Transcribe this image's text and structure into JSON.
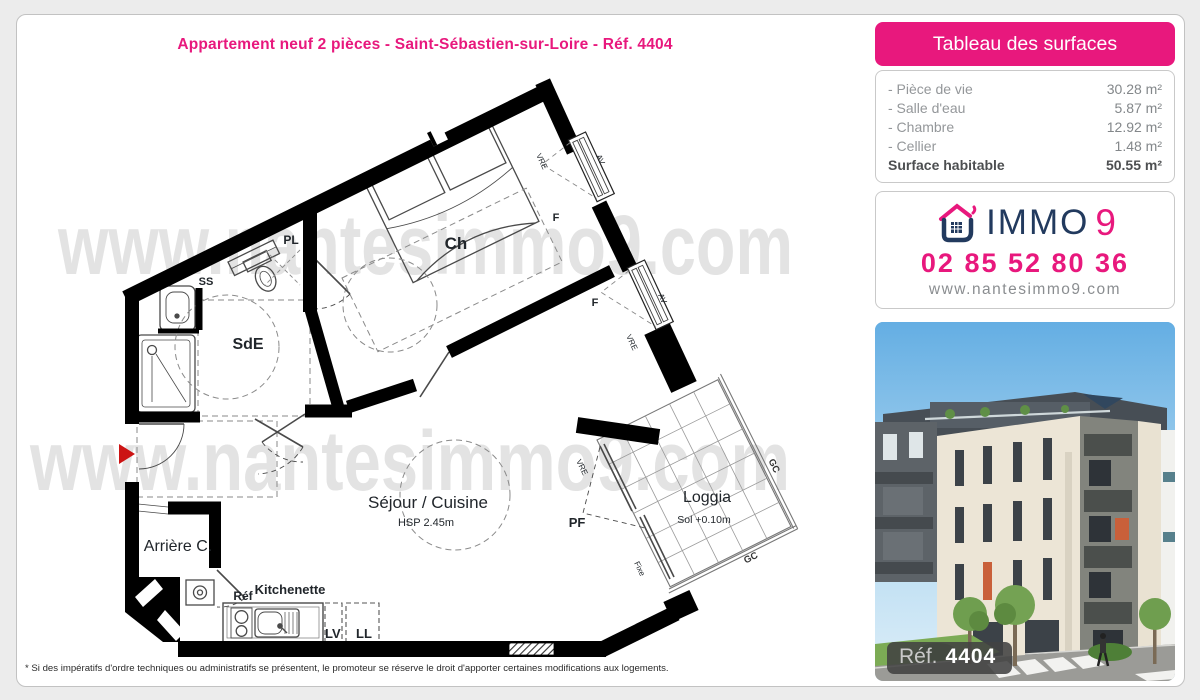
{
  "page": {
    "title": "Appartement neuf 2 pièces - Saint-Sébastien-sur-Loire - Réf. 4404",
    "disclaimer": "* Si des impératifs d'ordre techniques ou administratifs se présentent, le promoteur se réserve le droit d'apporter certaines modifications aux logements."
  },
  "surface_table": {
    "header": "Tableau des surfaces",
    "rows": [
      {
        "label": "- Pièce de vie",
        "value": "30.28 m²"
      },
      {
        "label": "- Salle d'eau",
        "value": "5.87 m²"
      },
      {
        "label": "- Chambre",
        "value": "12.92 m²"
      },
      {
        "label": "- Cellier",
        "value": "1.48 m²"
      }
    ],
    "total": {
      "label": "Surface habitable",
      "value": "50.55 m²"
    }
  },
  "agency": {
    "brand_immo": "IMMO",
    "brand_9": "9",
    "phone": "02 85 52 80 36",
    "website": "www.nantesimmo9.com"
  },
  "photo": {
    "ref_label": "Réf.",
    "ref_number": "4404"
  },
  "floorplan": {
    "watermark": "www.nantesimmo9.com",
    "labels": {
      "ch": "Ch",
      "sde": "SdE",
      "pl": "PL",
      "ss": "SS",
      "sejour": "Séjour / Cuisine",
      "hsp": "HSP 2.45m",
      "arriere": "Arrière C.",
      "kitchenette": "Kitchenette",
      "refrigerator": "Réf",
      "lv": "LV",
      "ll": "LL",
      "loggia": "Loggia",
      "sol": "Sol +0.10m",
      "pf": "PF",
      "f": "F",
      "av": "AV",
      "vre": "VRE",
      "gc": "GC",
      "fixe": "Fixe"
    }
  },
  "colors": {
    "accent_pink": "#e8187d",
    "brand_navy": "#223a5e",
    "wall_black": "#000000",
    "entrance_arrow_red": "#cc1414"
  }
}
